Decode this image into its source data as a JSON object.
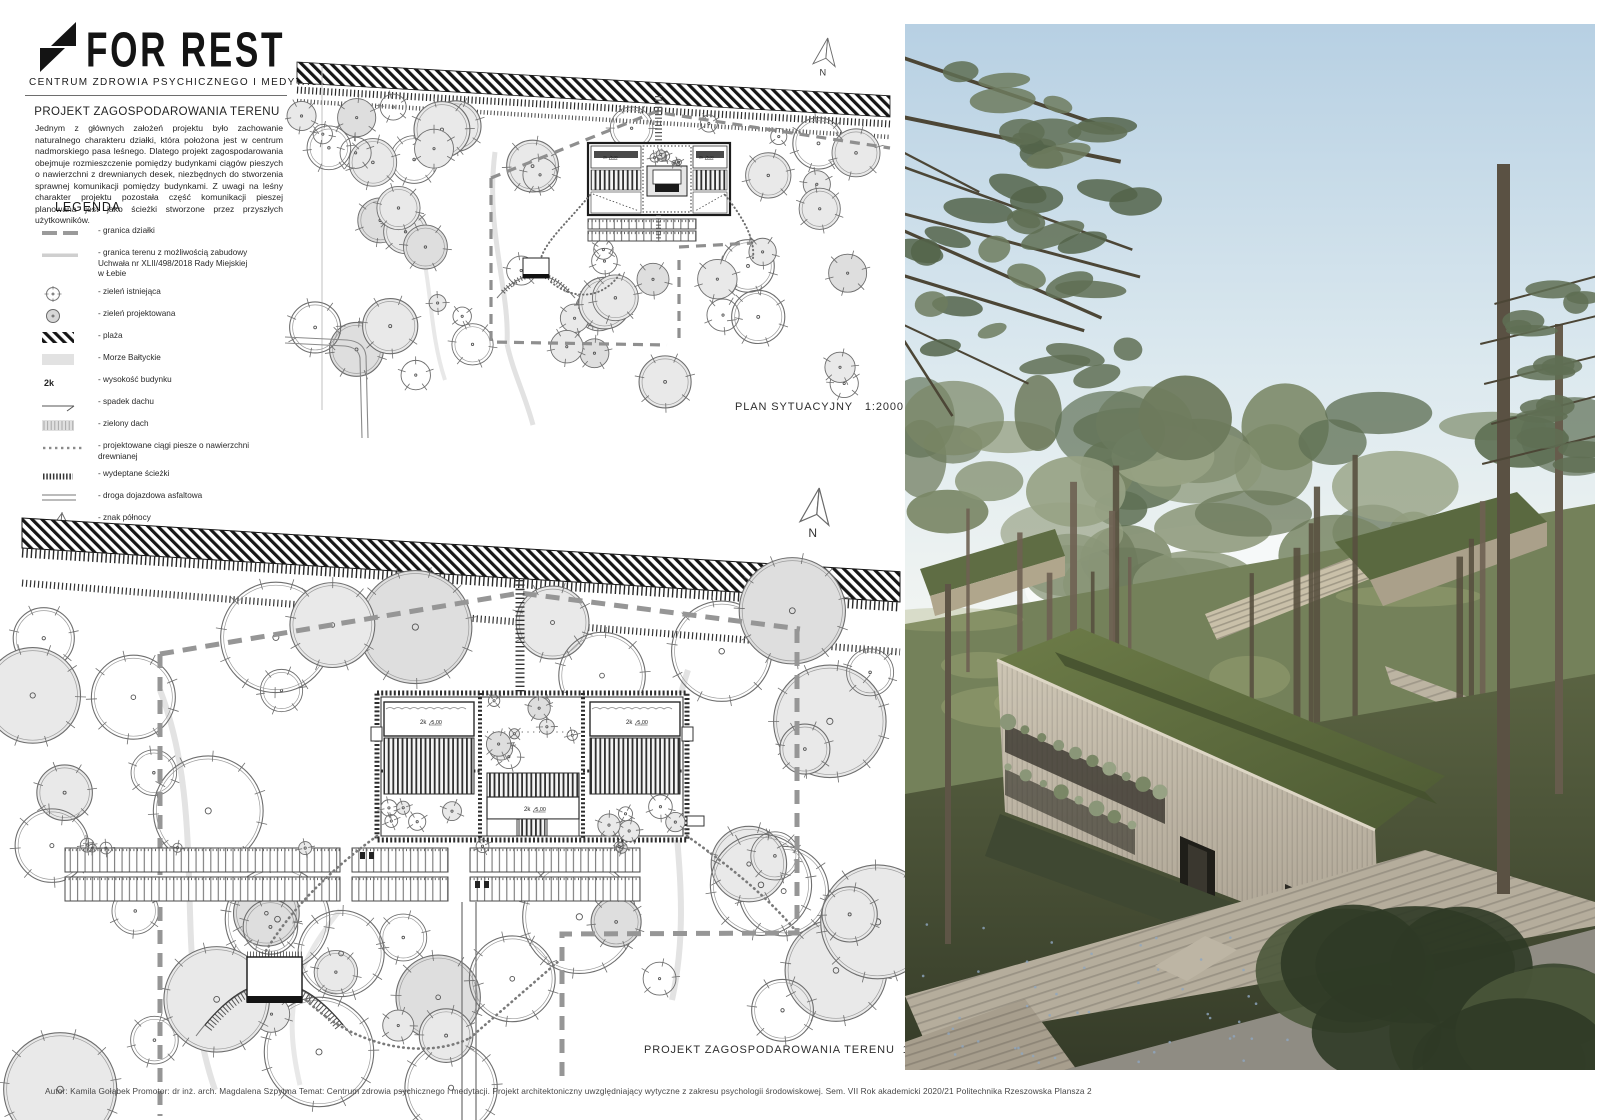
{
  "board": {
    "logo": {
      "icon": "bolt-tree-icon",
      "title": "FOR REST",
      "subtitle": "CENTRUM ZDROWIA PSYCHICZNEGO I MEDYTACJI"
    },
    "intro": {
      "heading": "PROJEKT ZAGOSPODAROWANIA TERENU",
      "body": "Jednym z głównych założeń projektu było zachowanie naturalnego charakteru działki, która położona jest w centrum nadmorskiego pasa leśnego. Dlatego projekt zagospodarowania obejmuje rozmieszczenie pomiędzy budynkami ciągów pieszych o nawierzchni z drewnianych desek, niezbędnych do stworzenia sprawnej komunikacji pomiędzy budynkami. Z uwagi na leśny charakter projektu pozostała część komunikacji pieszej planowana jest jako ścieżki stworzone przez przyszłych użytkowników."
    },
    "legend": {
      "heading": "LEGENDA",
      "items": [
        {
          "symbol": "boundary-dash-line",
          "label": "- granica działki"
        },
        {
          "symbol": "buildable-area-line",
          "label": "- granica terenu z możliwością zabudowy\n  Uchwała nr XLII/498/2018 Rady Miejskiej\n  w Łebie"
        },
        {
          "symbol": "existing-greenery",
          "label": "- zieleń istniejąca"
        },
        {
          "symbol": "designed-greenery",
          "label": "- zieleń projektowana"
        },
        {
          "symbol": "beach",
          "label": "- plaża"
        },
        {
          "symbol": "baltic-sea",
          "label": "- Morze Bałtyckie"
        },
        {
          "symbol": "building-height",
          "symbol_text": "2k",
          "label": "- wysokość budynku"
        },
        {
          "symbol": "roof-slope",
          "label": "- spadek dachu"
        },
        {
          "symbol": "green-roof",
          "label": "- zielony dach"
        },
        {
          "symbol": "wooden-walkway",
          "label": "- projektowane ciągi piesze o nawierzchni\n  drewnianej"
        },
        {
          "symbol": "trodden-path",
          "label": "- wydeptane ścieżki"
        },
        {
          "symbol": "asphalt-road",
          "label": "- droga dojazdowa asfaltowa"
        },
        {
          "symbol": "north-sign",
          "label": "- znak północy"
        }
      ]
    },
    "plans": [
      {
        "title": "PLAN SYTUACYJNY",
        "scale": "1:2000",
        "north_label": "N",
        "height_label": "2k",
        "level_label": "5,00"
      },
      {
        "title": "PROJEKT ZAGOSPODAROWANIA TERENU",
        "scale": "1:1000",
        "north_label": "N",
        "height_label": "2k",
        "level_label": "5,00"
      }
    ],
    "footer": {
      "text": "Autor: Kamila Gołąbek   Promotor: dr inż. arch. Magdalena Szpytma   Temat: Centrum zdrowia psychicznego i medytacji. Projekt architektoniczny uwzględniający wytyczne z zakresu psychologii środowiskowej.   Sem. VII  Rok akademicki 2020/21   Politechnika Rzeszowska  Plansza 2"
    },
    "colors": {
      "ink": "#1a1a1a",
      "plan_line": "#6e6e6e",
      "tree_fill": "#e9e9e9",
      "boundary_dash": "#979797",
      "beach_hatch": "#141414",
      "sky_top": "#b7d0e3",
      "sky_horizon": "#f2f5f3",
      "forest_green": "#77825a",
      "green_roof": "#5c6b3d",
      "wood_facade": "#c1b8a7",
      "boardwalk": "#b5ad9c",
      "road": "#8f8c83"
    }
  }
}
